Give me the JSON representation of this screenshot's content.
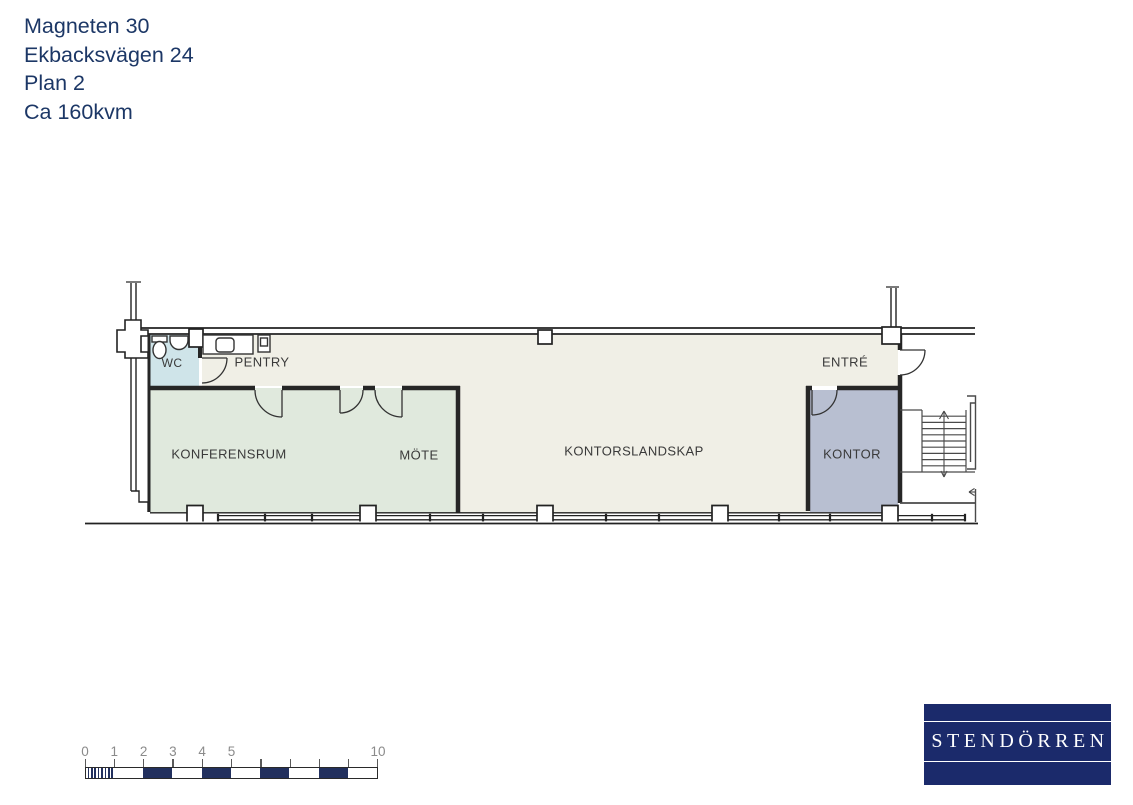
{
  "title_block": {
    "lines": [
      "Magneten 30",
      "Ekbacksvägen 24",
      "Plan 2",
      "Ca 160kvm"
    ]
  },
  "floor_plan": {
    "rooms": {
      "wc": "WC",
      "pentry": "PENTRY",
      "konferensrum": "KONFERENSRUM",
      "mote": "MÖTE",
      "kontorslandskap": "KONTORSLANDSKAP",
      "entre": "ENTRÉ",
      "kontor": "KONTOR"
    }
  },
  "scale_bar": {
    "labels": [
      "0",
      "1",
      "2",
      "3",
      "4",
      "5",
      "10"
    ],
    "unit_max_meters": 10
  },
  "logo": {
    "text": "STENDÖRREN"
  },
  "colors": {
    "title_text": "#1c3766",
    "wc_fill": "#cfe4e9",
    "conference_fill": "#e0e9dd",
    "open_office_fill": "#f0efe6",
    "kontor_fill": "#b8bfd1",
    "scale_navy": "#22305e",
    "logo_bg": "#1b2a6b"
  }
}
